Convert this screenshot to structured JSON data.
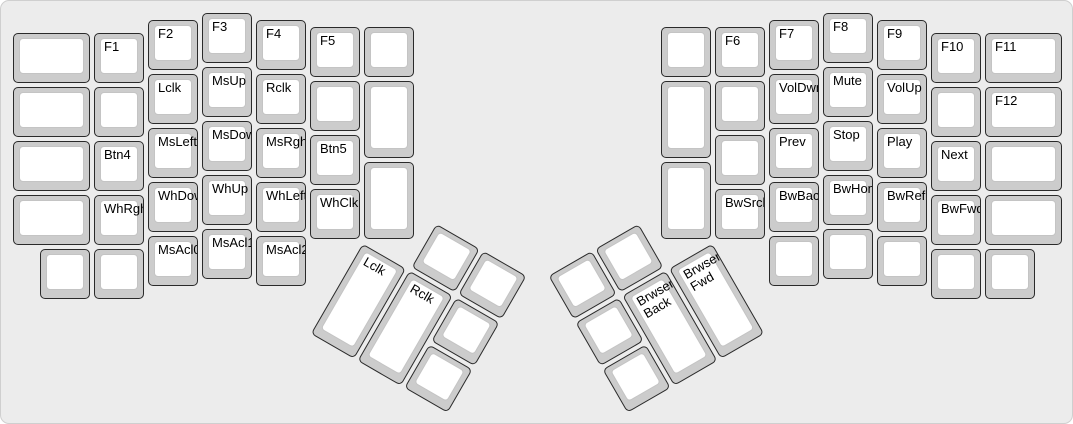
{
  "colors": {
    "case_bg": "#ececec",
    "key_base": "#cccccc",
    "key_face": "#ffffff",
    "key_border": "#2a2a2a",
    "face_border": "#c4c4c4",
    "label_color": "#000000"
  },
  "keyboard": {
    "name": "ergodox-mouse-media-function-layer",
    "groups": [
      {
        "name": "left-main",
        "r": 0,
        "rx": 0,
        "ry": 0,
        "keys": [
          {
            "label": "",
            "x": 0,
            "y": 0.375,
            "w": 1.5
          },
          {
            "label": "F1",
            "x": 1.5,
            "y": 0.375
          },
          {
            "label": "F2",
            "x": 2.5,
            "y": 0.125
          },
          {
            "label": "F3",
            "x": 3.5,
            "y": 0
          },
          {
            "label": "F4",
            "x": 4.5,
            "y": 0.125
          },
          {
            "label": "F5",
            "x": 5.5,
            "y": 0.25
          },
          {
            "label": "",
            "x": 6.5,
            "y": 0.25
          },
          {
            "label": "",
            "x": 0,
            "y": 1.375,
            "w": 1.5
          },
          {
            "label": "",
            "x": 1.5,
            "y": 1.375
          },
          {
            "label": "Lclk",
            "x": 2.5,
            "y": 1.125
          },
          {
            "label": "MsUp",
            "x": 3.5,
            "y": 1
          },
          {
            "label": "Rclk",
            "x": 4.5,
            "y": 1.125
          },
          {
            "label": "",
            "x": 5.5,
            "y": 1.25
          },
          {
            "label": "",
            "x": 6.5,
            "y": 1.25,
            "h": 1.5
          },
          {
            "label": "",
            "x": 0,
            "y": 2.375,
            "w": 1.5
          },
          {
            "label": "Btn4",
            "x": 1.5,
            "y": 2.375
          },
          {
            "label": "MsLeft",
            "x": 2.5,
            "y": 2.125
          },
          {
            "label": "MsDown",
            "x": 3.5,
            "y": 2
          },
          {
            "label": "MsRght",
            "x": 4.5,
            "y": 2.125
          },
          {
            "label": "Btn5",
            "x": 5.5,
            "y": 2.25
          },
          {
            "label": "",
            "x": 0,
            "y": 3.375,
            "w": 1.5
          },
          {
            "label": "WhRght",
            "x": 1.5,
            "y": 3.375
          },
          {
            "label": "WhDown",
            "x": 2.5,
            "y": 3.125
          },
          {
            "label": "WhUp",
            "x": 3.5,
            "y": 3
          },
          {
            "label": "WhLeft",
            "x": 4.5,
            "y": 3.125
          },
          {
            "label": "WhClk",
            "x": 5.5,
            "y": 3.25
          },
          {
            "label": "",
            "x": 6.5,
            "y": 2.75,
            "h": 1.5
          },
          {
            "label": "",
            "x": 0.5,
            "y": 4.375
          },
          {
            "label": "",
            "x": 1.5,
            "y": 4.375
          },
          {
            "label": "MsAcl0",
            "x": 2.5,
            "y": 4.125
          },
          {
            "label": "MsAcl1",
            "x": 3.5,
            "y": 4
          },
          {
            "label": "MsAcl2",
            "x": 4.5,
            "y": 4.125
          }
        ]
      },
      {
        "name": "right-main",
        "r": 0,
        "rx": 0,
        "ry": 0,
        "keys": [
          {
            "label": "",
            "x": 12,
            "y": 0.25
          },
          {
            "label": "F6",
            "x": 13,
            "y": 0.25
          },
          {
            "label": "F7",
            "x": 14,
            "y": 0.125
          },
          {
            "label": "F8",
            "x": 15,
            "y": 0
          },
          {
            "label": "F9",
            "x": 16,
            "y": 0.125
          },
          {
            "label": "F10",
            "x": 17,
            "y": 0.375
          },
          {
            "label": "F11",
            "x": 18,
            "y": 0.375,
            "w": 1.5
          },
          {
            "label": "",
            "x": 12,
            "y": 1.25,
            "h": 1.5
          },
          {
            "label": "",
            "x": 13,
            "y": 1.25
          },
          {
            "label": "VolDwn",
            "x": 14,
            "y": 1.125
          },
          {
            "label": "Mute",
            "x": 15,
            "y": 1
          },
          {
            "label": "VolUp",
            "x": 16,
            "y": 1.125
          },
          {
            "label": "",
            "x": 17,
            "y": 1.375
          },
          {
            "label": "F12",
            "x": 18,
            "y": 1.375,
            "w": 1.5
          },
          {
            "label": "",
            "x": 13,
            "y": 2.25
          },
          {
            "label": "Prev",
            "x": 14,
            "y": 2.125
          },
          {
            "label": "Stop",
            "x": 15,
            "y": 2
          },
          {
            "label": "Play",
            "x": 16,
            "y": 2.125
          },
          {
            "label": "Next",
            "x": 17,
            "y": 2.375
          },
          {
            "label": "",
            "x": 18,
            "y": 2.375,
            "w": 1.5
          },
          {
            "label": "",
            "x": 12,
            "y": 2.75,
            "h": 1.5
          },
          {
            "label": "BwSrch",
            "x": 13,
            "y": 3.25
          },
          {
            "label": "BwBack",
            "x": 14,
            "y": 3.125
          },
          {
            "label": "BwHome",
            "x": 15,
            "y": 3
          },
          {
            "label": "BwRefr",
            "x": 16,
            "y": 3.125
          },
          {
            "label": "BwFwd",
            "x": 17,
            "y": 3.375
          },
          {
            "label": "",
            "x": 18,
            "y": 3.375,
            "w": 1.5
          },
          {
            "label": "",
            "x": 14,
            "y": 4.125
          },
          {
            "label": "",
            "x": 15,
            "y": 4
          },
          {
            "label": "",
            "x": 16,
            "y": 4.125
          },
          {
            "label": "",
            "x": 17,
            "y": 4.375
          },
          {
            "label": "",
            "x": 18,
            "y": 4.375
          }
        ]
      },
      {
        "name": "left-thumb-cluster",
        "r": 30,
        "rx": 6.5,
        "ry": 4.25,
        "keys": [
          {
            "label": "",
            "x": 1,
            "y": -1
          },
          {
            "label": "",
            "x": 2,
            "y": -1
          },
          {
            "label": "Lclk",
            "x": 0,
            "y": 0,
            "h": 2
          },
          {
            "label": "Rclk",
            "x": 1,
            "y": 0,
            "h": 2
          },
          {
            "label": "",
            "x": 2,
            "y": 0
          },
          {
            "label": "",
            "x": 2,
            "y": 1
          }
        ]
      },
      {
        "name": "right-thumb-cluster",
        "r": -30,
        "rx": 13,
        "ry": 4.25,
        "keys": [
          {
            "label": "",
            "x": -3,
            "y": -1
          },
          {
            "label": "",
            "x": -2,
            "y": -1
          },
          {
            "label": "",
            "x": -3,
            "y": 0
          },
          {
            "label": "Brwser\nBack",
            "x": -2,
            "y": 0,
            "h": 2
          },
          {
            "label": "Brwser\nFwd",
            "x": -1,
            "y": 0,
            "h": 2
          },
          {
            "label": "",
            "x": -3,
            "y": 1
          }
        ]
      }
    ]
  }
}
